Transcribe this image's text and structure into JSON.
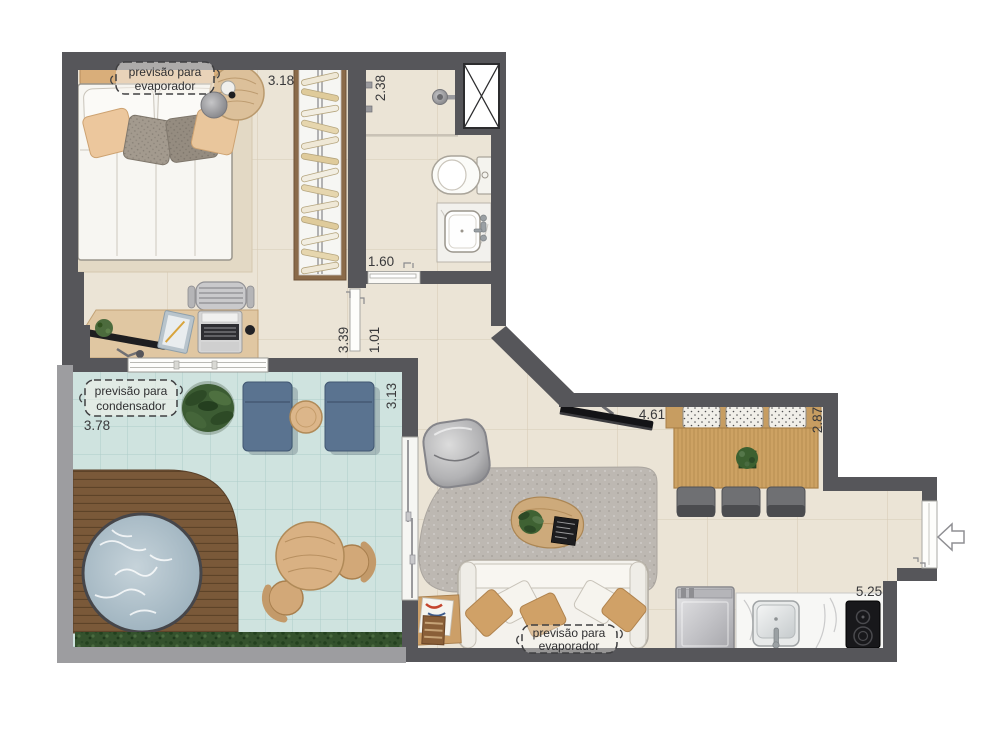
{
  "plan": {
    "type": "apartment-floor-plan",
    "labels": {
      "bedroom_ac": {
        "line1": "previsão para",
        "line2": "evaporador"
      },
      "balcony_ac": {
        "line1": "previsão para",
        "line2": "condensador"
      },
      "living_ac": {
        "line1": "previsão para",
        "line2": "evaporador"
      }
    },
    "dimensions": {
      "bedroom_width": "3.18",
      "bathroom_length": "2.38",
      "bath_door_width": "1.60",
      "bedroom_length": "3.39",
      "hall_width": "1.01",
      "balcony_width": "3.78",
      "balcony_depth": "3.13",
      "living_width": "4.61",
      "dining_depth": "2.87",
      "kitchen_width": "5.25"
    },
    "icons": {
      "entry_arrow": "left-arrow"
    },
    "colors": {
      "wall_dark": "#56565a",
      "wall_light": "#9d9da0",
      "floor": "#ebe4d6",
      "balcony_floor": "#cfe3df",
      "deck": "#7a5939",
      "water": "#a9bcc6",
      "wood": "#c79d61",
      "lounge_blue": "#5a7390",
      "sofa": "#f4f2ed",
      "cushion": "#d0a167",
      "text": "#39393b"
    }
  }
}
